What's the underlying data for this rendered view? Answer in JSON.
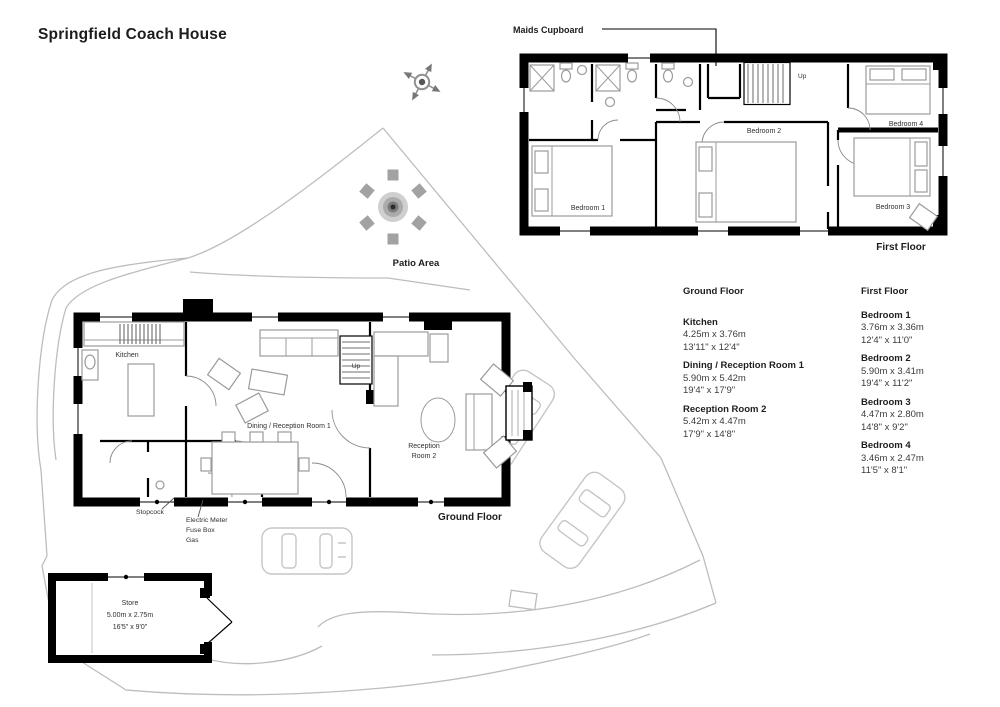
{
  "title": "Springfield Coach House",
  "colors": {
    "walls": "#000000",
    "boundary": "#bdbdbd",
    "furniture": "#9b9b9b"
  },
  "first_floor": {
    "caption": "First Floor",
    "maids_cupboard": "Maids Cupboard",
    "up": "Up",
    "rooms": {
      "bedroom1": "Bedroom 1",
      "bedroom2": "Bedroom 2",
      "bedroom3": "Bedroom 3",
      "bedroom4": "Bedroom 4"
    }
  },
  "ground_floor": {
    "caption": "Ground Floor",
    "up": "Up",
    "rooms": {
      "kitchen": "Kitchen",
      "dining": "Dining / Reception Room 1",
      "reception_line1": "Reception",
      "reception_line2": "Room 2"
    },
    "annotations": {
      "stopcock": "Stopcock",
      "electric_meter": "Electric Meter",
      "fuse_box": "Fuse Box",
      "gas": "Gas"
    }
  },
  "patio": {
    "label": "Patio Area"
  },
  "store": {
    "label": "Store",
    "metric": "5.00m x 2.75m",
    "imperial": "16'5\" x 9'0\""
  },
  "legend": {
    "ground": {
      "heading": "Ground Floor",
      "rooms": [
        {
          "name": "Kitchen",
          "metric": "4.25m x 3.76m",
          "imperial": "13'11\" x 12'4\""
        },
        {
          "name": "Dining / Reception Room 1",
          "metric": "5.90m x 5.42m",
          "imperial": "19'4\" x 17'9\""
        },
        {
          "name": "Reception Room 2",
          "metric": "5.42m x 4.47m",
          "imperial": "17'9\" x 14'8\""
        }
      ]
    },
    "first": {
      "heading": "First Floor",
      "rooms": [
        {
          "name": "Bedroom 1",
          "metric": "3.76m x 3.36m",
          "imperial": "12'4\" x 11'0\""
        },
        {
          "name": "Bedroom 2",
          "metric": "5.90m x 3.41m",
          "imperial": "19'4\" x 11'2\""
        },
        {
          "name": "Bedroom 3",
          "metric": "4.47m x 2.80m",
          "imperial": "14'8\" x 9'2\""
        },
        {
          "name": "Bedroom 4",
          "metric": "3.46m x 2.47m",
          "imperial": "11'5\" x 8'1\""
        }
      ]
    }
  }
}
